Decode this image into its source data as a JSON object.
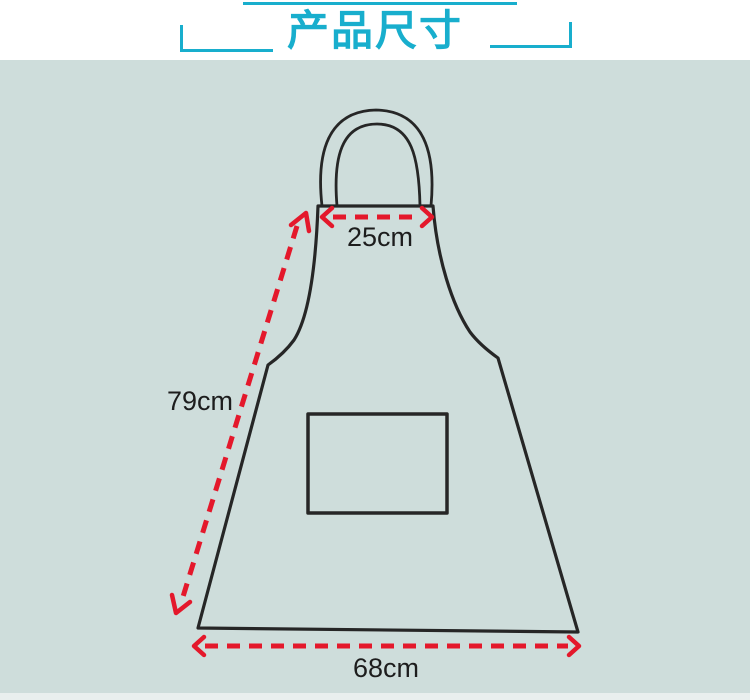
{
  "title": {
    "text": "产品尺寸"
  },
  "colors": {
    "accent_teal": "#18aecd",
    "panel_background": "#cedddb",
    "dimension_red": "#e4182b",
    "outline_dark": "#262626",
    "label_text": "#1d1d1d"
  },
  "diagram": {
    "subject": "apron-line-drawing",
    "parts": [
      "neck-strap",
      "bib",
      "skirt",
      "front-pocket"
    ],
    "dimensions": [
      {
        "id": "top-width",
        "label": "25cm",
        "measures": "bib top edge width"
      },
      {
        "id": "side-length",
        "label": "79cm",
        "measures": "diagonal side length from bib top to hem"
      },
      {
        "id": "bottom-width",
        "label": "68cm",
        "measures": "bottom hem width"
      }
    ]
  }
}
